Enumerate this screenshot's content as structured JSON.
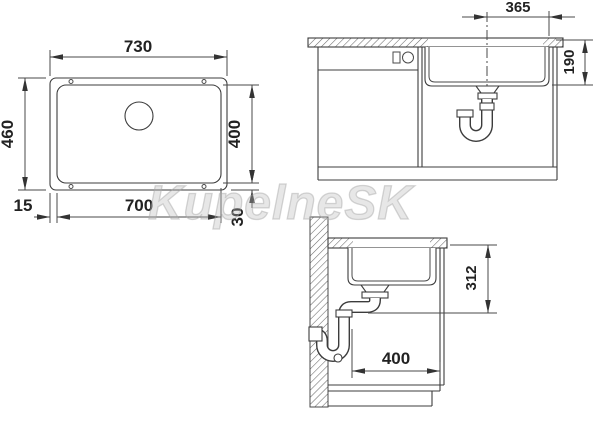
{
  "watermark": "KupelneSK",
  "dims": {
    "top_outer_width": "730",
    "top_outer_depth": "460",
    "top_inner_depth": "400",
    "top_inner_width": "700",
    "top_offset_side": "15",
    "top_offset_bottom": "30",
    "front_center_to_edge": "365",
    "front_bowl_depth": "190",
    "side_top_to_outlet": "312",
    "side_bowl_width": "400"
  }
}
